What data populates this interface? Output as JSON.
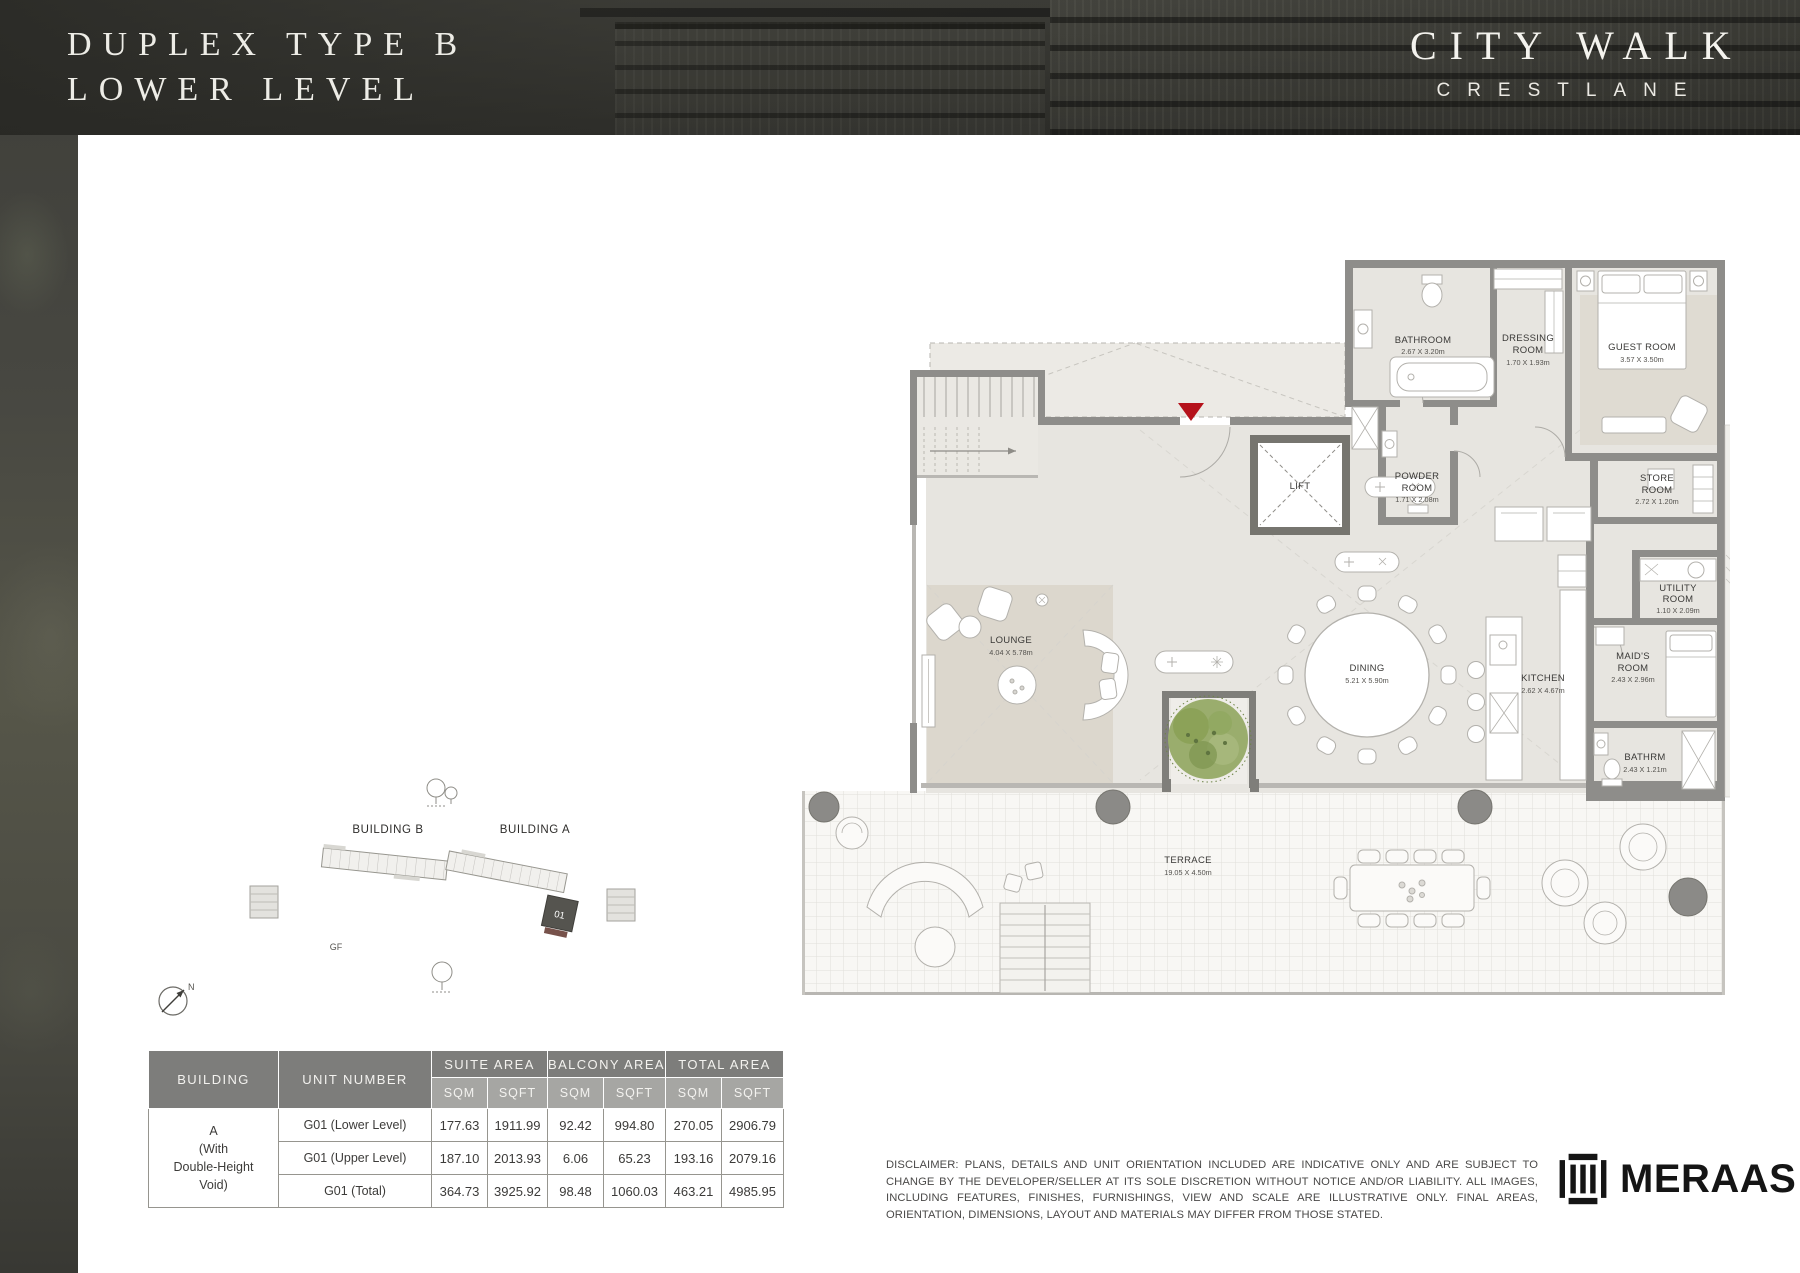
{
  "header": {
    "title_line1": "DUPLEX TYPE B",
    "title_line2": "LOWER LEVEL",
    "brand_name": "CITY WALK",
    "brand_sub": "CRESTLANE"
  },
  "locator": {
    "building_b_label": "BUILDING B",
    "building_a_label": "BUILDING A",
    "floor_label": "GF",
    "unit_label": "01",
    "compass_label": "N"
  },
  "plan": {
    "entry_marker_color": "#b5121b",
    "rooms": {
      "bathroom": {
        "l1": "BATHROOM",
        "dims": "2.67 X 3.20m"
      },
      "dressing": {
        "l1": "DRESSING",
        "l2": "ROOM",
        "dims": "1.70 X 1.93m"
      },
      "guest": {
        "l1": "GUEST ROOM",
        "dims": "3.57 X 3.50m"
      },
      "lift": {
        "l1": "LIFT"
      },
      "powder": {
        "l1": "POWDER",
        "l2": "ROOM",
        "dims": "1.71 X 2.08m"
      },
      "store": {
        "l1": "STORE",
        "l2": "ROOM",
        "dims": "2.72 X 1.20m"
      },
      "utility": {
        "l1": "UTILITY",
        "l2": "ROOM",
        "dims": "1.10 X 2.09m"
      },
      "maids": {
        "l1": "MAID'S",
        "l2": "ROOM",
        "dims": "2.43 X 2.96m"
      },
      "bathrm": {
        "l1": "BATHRM",
        "dims": "2.43 X 1.21m"
      },
      "lounge": {
        "l1": "LOUNGE",
        "dims": "4.04 X 5.78m"
      },
      "dining": {
        "l1": "DINING",
        "dims": "5.21 X 5.90m"
      },
      "kitchen": {
        "l1": "KITCHEN",
        "dims": "2.62 X 4.67m"
      },
      "terrace": {
        "l1": "TERRACE",
        "dims": "19.05 X 4.50m"
      }
    }
  },
  "table": {
    "headers": {
      "building": "BUILDING",
      "unit_number": "UNIT NUMBER",
      "suite_area": "SUITE AREA",
      "balcony_area": "BALCONY AREA",
      "total_area": "TOTAL AREA",
      "sqm": "SQM",
      "sqft": "SQFT"
    },
    "building_cell": "A\n(With\nDouble-Height\nVoid)",
    "rows": [
      {
        "unit": "G01 (Lower Level)",
        "suite_sqm": "177.63",
        "suite_sqft": "1911.99",
        "balcony_sqm": "92.42",
        "balcony_sqft": "994.80",
        "total_sqm": "270.05",
        "total_sqft": "2906.79"
      },
      {
        "unit": "G01 (Upper Level)",
        "suite_sqm": "187.10",
        "suite_sqft": "2013.93",
        "balcony_sqm": "6.06",
        "balcony_sqft": "65.23",
        "total_sqm": "193.16",
        "total_sqft": "2079.16"
      },
      {
        "unit": "G01 (Total)",
        "suite_sqm": "364.73",
        "suite_sqft": "3925.92",
        "balcony_sqm": "98.48",
        "balcony_sqft": "1060.03",
        "total_sqm": "463.21",
        "total_sqft": "4985.95"
      }
    ]
  },
  "footer": {
    "disclaimer": "DISCLAIMER: PLANS, DETAILS AND UNIT ORIENTATION INCLUDED ARE INDICATIVE ONLY AND ARE SUBJECT TO CHANGE BY THE DEVELOPER/SELLER AT ITS SOLE DISCRETION WITHOUT NOTICE AND/OR LIABILITY. ALL IMAGES, INCLUDING FEATURES, FINISHES, FURNISHINGS, VIEW AND SCALE ARE ILLUSTRATIVE ONLY. FINAL AREAS, ORIENTATION, DIMENSIONS, LAYOUT AND MATERIALS MAY DIFFER FROM THOSE STATED.",
    "logo_text": "MERAAS"
  }
}
